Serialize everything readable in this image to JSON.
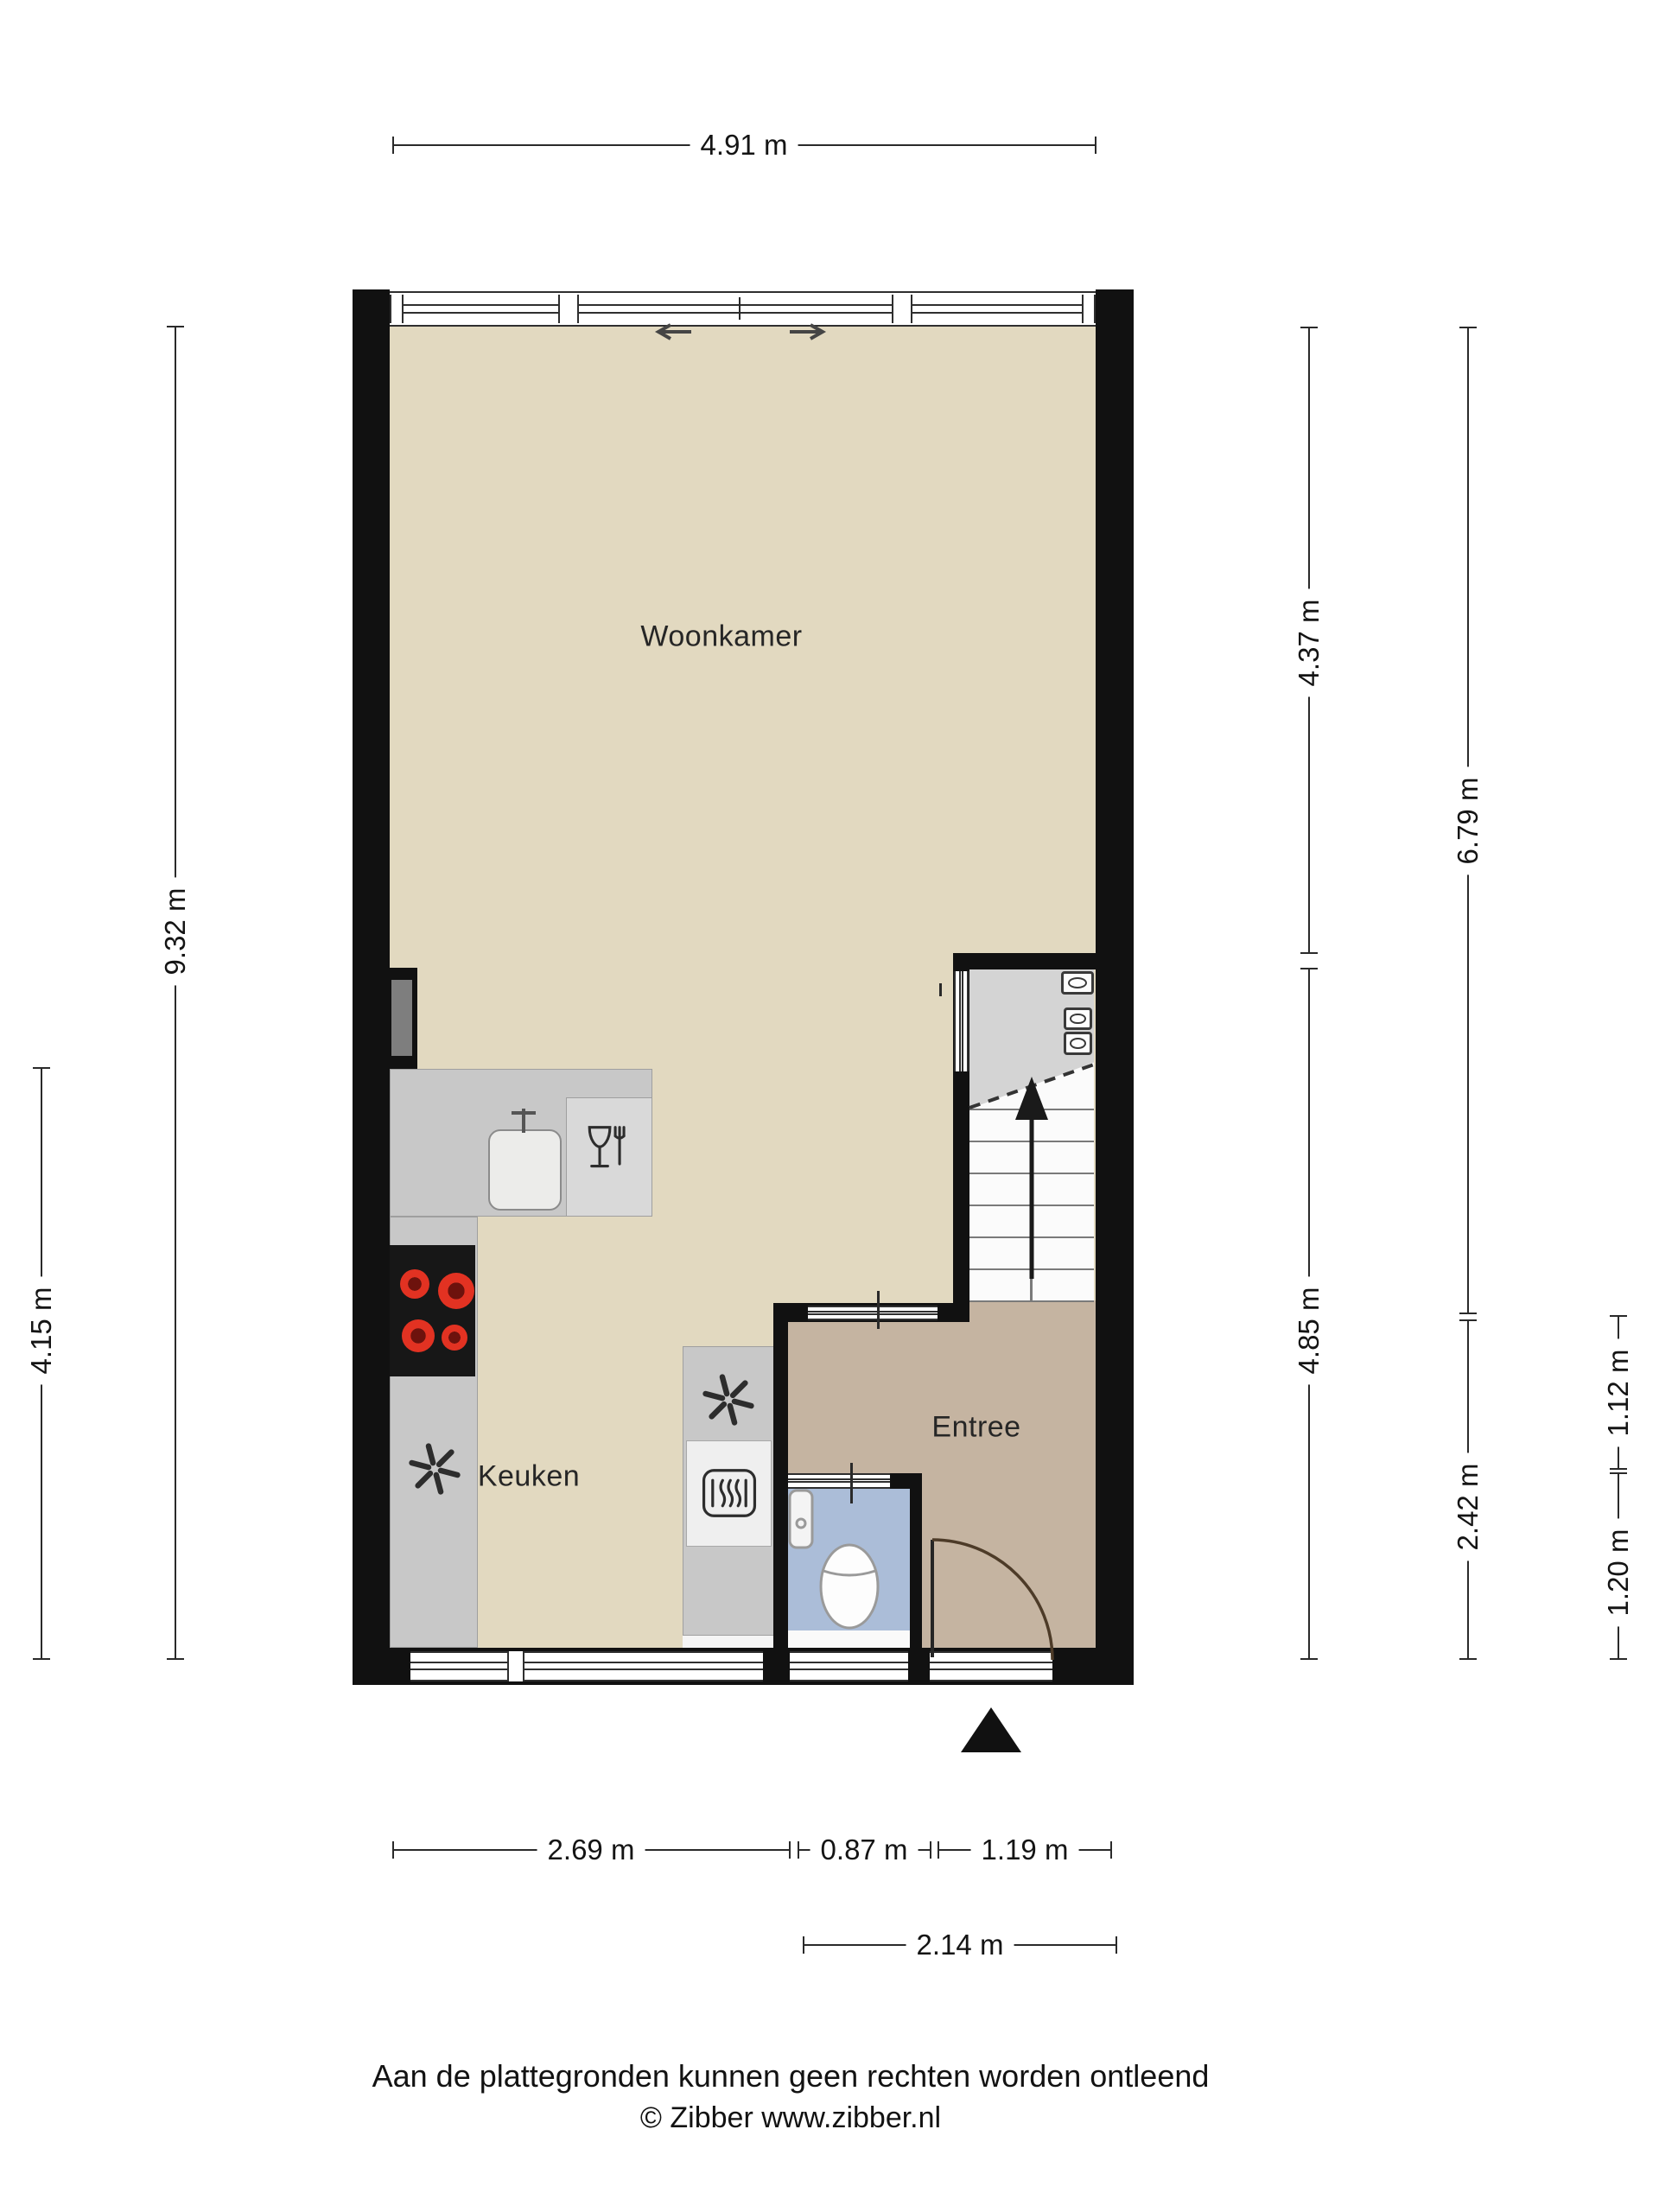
{
  "plan": {
    "type": "floorplan",
    "floor_label": "Begane grond"
  },
  "rooms": {
    "woonkamer": {
      "label": "Woonkamer"
    },
    "keuken": {
      "label": "Keuken"
    },
    "entree": {
      "label": "Entree"
    }
  },
  "dimensions": {
    "top_width": {
      "label": "4.91 m"
    },
    "left_total": {
      "label": "9.32 m"
    },
    "left_kitchen": {
      "label": "4.15 m"
    },
    "right_upper": {
      "label": "4.37 m"
    },
    "right_lower": {
      "label": "4.85 m"
    },
    "right_living": {
      "label": "6.79 m"
    },
    "right_entree": {
      "label": "2.42 m"
    },
    "right_hall_upper": {
      "label": "1.12 m"
    },
    "right_toilet": {
      "label": "1.20 m"
    },
    "bottom_kitchen": {
      "label": "2.69 m"
    },
    "bottom_toilet": {
      "label": "0.87 m"
    },
    "bottom_door": {
      "label": "1.19 m"
    },
    "bottom_entree": {
      "label": "2.14 m"
    }
  },
  "icons": {
    "fan_kitchen": "ventilation-fan",
    "fan_column": "ventilation-fan",
    "oven": "oven",
    "dishwasher": "dishwasher",
    "cooktop": "cooktop-4-burners",
    "toilet": "toilet",
    "hand_basin": "hand-basin",
    "meters": "meter-cupboard-units",
    "stairs": "staircase-up",
    "sliding_door": "sliding-door-arrows",
    "entrance_marker": "entrance-triangle"
  },
  "colors": {
    "living_floor": "#e2d9c0",
    "entree_floor": "#c5b4a1",
    "toilet_floor": "#abbdd8",
    "counter": "#c8c8c8",
    "wall": "#111111",
    "burner_red": "#e23222",
    "door_arc": "#4d3b28",
    "meterkast_gray": "#d4d4d4"
  },
  "footer": {
    "disclaimer": "Aan de plattegronden kunnen geen rechten worden ontleend",
    "credit": "© Zibber www.zibber.nl"
  }
}
